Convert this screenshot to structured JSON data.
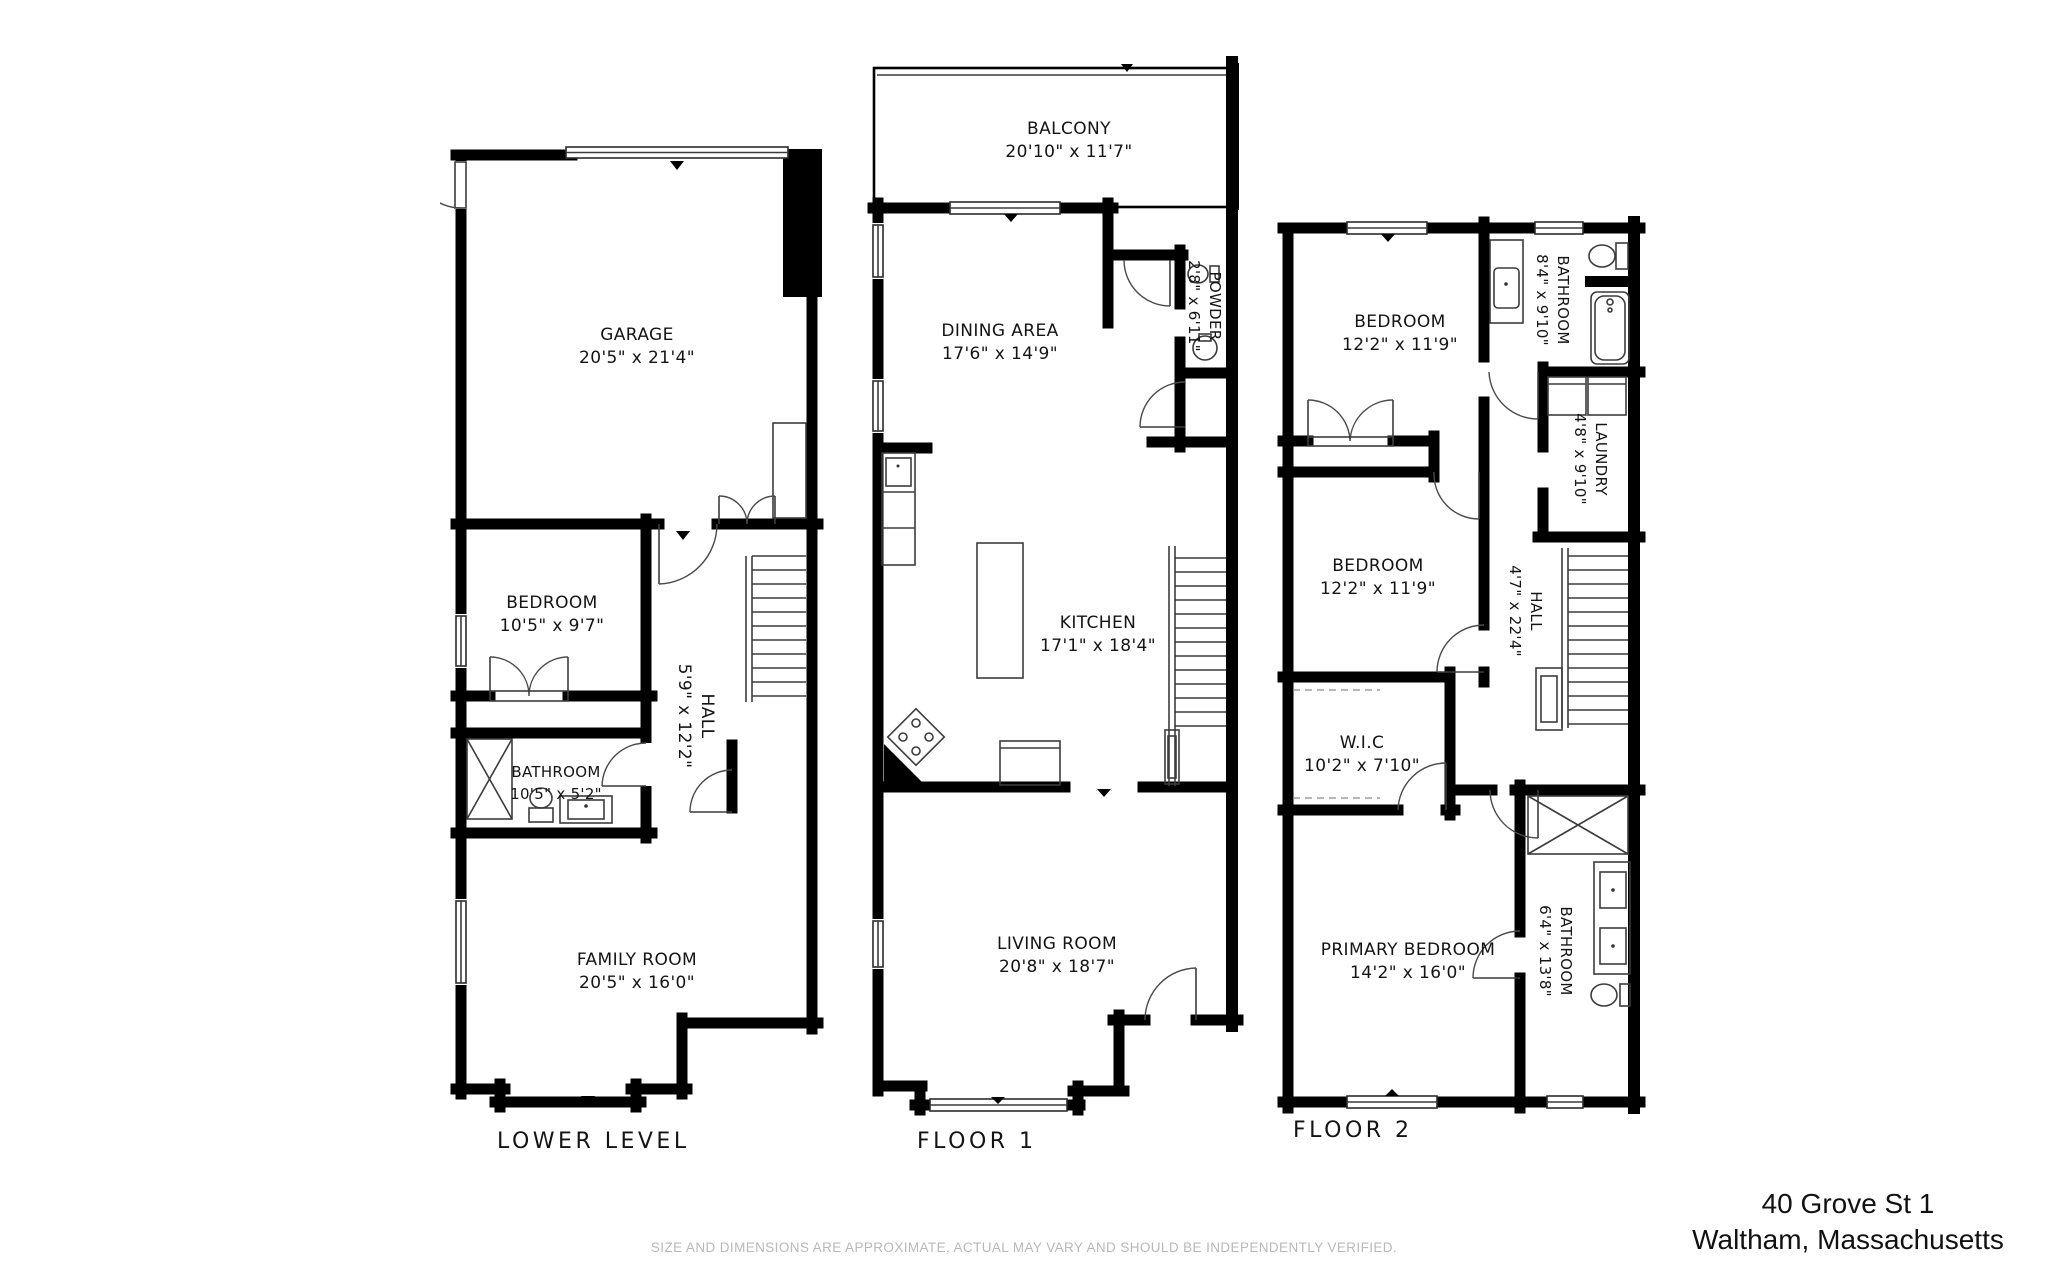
{
  "floors": [
    {
      "label": "LOWER LEVEL",
      "rooms": [
        {
          "name": "GARAGE",
          "dims": "20'5\" x 21'4\""
        },
        {
          "name": "BEDROOM",
          "dims": "10'5\" x 9'7\""
        },
        {
          "name": "HALL",
          "dims": "5'9\" x 12'2\""
        },
        {
          "name": "BATHROOM",
          "dims": "10'5\" x 5'2\""
        },
        {
          "name": "FAMILY ROOM",
          "dims": "20'5\" x 16'0\""
        }
      ]
    },
    {
      "label": "FLOOR 1",
      "rooms": [
        {
          "name": "BALCONY",
          "dims": "20'10\" x 11'7\""
        },
        {
          "name": "DINING AREA",
          "dims": "17'6\" x 14'9\""
        },
        {
          "name": "POWDER",
          "dims": "2'8\" x 6'11\""
        },
        {
          "name": "KITCHEN",
          "dims": "17'1\" x 18'4\""
        },
        {
          "name": "LIVING ROOM",
          "dims": "20'8\" x 18'7\""
        }
      ]
    },
    {
      "label": "FLOOR 2",
      "rooms": [
        {
          "name": "BEDROOM",
          "dims": "12'2\" x 11'9\""
        },
        {
          "name": "BATHROOM",
          "dims": "8'4\" x 9'10\""
        },
        {
          "name": "LAUNDRY",
          "dims": "4'8\" x 9'10\""
        },
        {
          "name": "BEDROOM",
          "dims": "12'2\" x 11'9\""
        },
        {
          "name": "HALL",
          "dims": "4'7\" x 22'4\""
        },
        {
          "name": "W.I.C",
          "dims": "10'2\" x 7'10\""
        },
        {
          "name": "PRIMARY BEDROOM",
          "dims": "14'2\" x 16'0\""
        },
        {
          "name": "BATHROOM",
          "dims": "6'4\" x 13'8\""
        }
      ]
    }
  ],
  "address": {
    "line1": "40 Grove St 1",
    "line2": "Waltham, Massachusetts"
  },
  "disclaimer": "SIZE AND DIMENSIONS ARE APPROXIMATE, ACTUAL MAY VARY AND SHOULD BE INDEPENDENTLY VERIFIED.",
  "colors": {
    "walls": "#000000",
    "label_text": "#141414",
    "disclaimer_text": "#b9b9b9"
  }
}
